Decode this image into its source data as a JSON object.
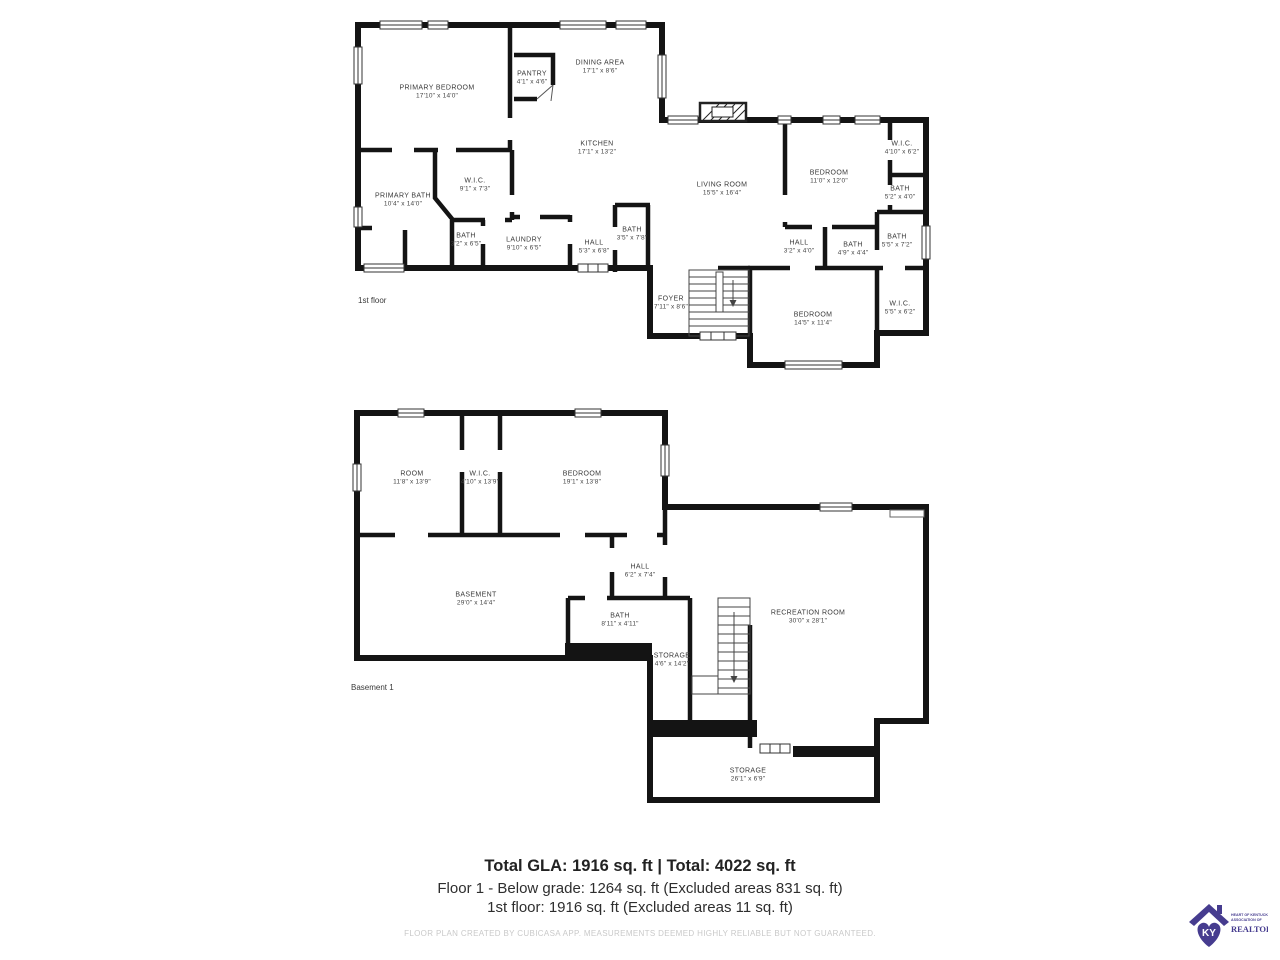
{
  "floors": [
    {
      "id": "floor-1",
      "label": "1st floor",
      "label_pos": {
        "x": 358,
        "y": 296
      },
      "rooms": [
        {
          "name": "PRIMARY BEDROOM",
          "dims": "17'10\" x 14'0\"",
          "x": 437,
          "y": 92
        },
        {
          "name": "PANTRY",
          "dims": "4'1\" x 4'6\"",
          "x": 532,
          "y": 78
        },
        {
          "name": "DINING AREA",
          "dims": "17'1\" x 8'6\"",
          "x": 600,
          "y": 67
        },
        {
          "name": "KITCHEN",
          "dims": "17'1\" x 13'2\"",
          "x": 597,
          "y": 148
        },
        {
          "name": "W.I.C.",
          "dims": "9'1\" x 7'3\"",
          "x": 475,
          "y": 185
        },
        {
          "name": "PRIMARY BATH",
          "dims": "10'4\" x 14'0\"",
          "x": 403,
          "y": 200
        },
        {
          "name": "BATH",
          "dims": "3'2\" x 6'5\"",
          "x": 466,
          "y": 240
        },
        {
          "name": "LAUNDRY",
          "dims": "9'10\" x 6'5\"",
          "x": 524,
          "y": 244
        },
        {
          "name": "HALL",
          "dims": "5'3\" x 6'8\"",
          "x": 594,
          "y": 247
        },
        {
          "name": "BATH",
          "dims": "3'5\" x 7'8\"",
          "x": 632,
          "y": 234
        },
        {
          "name": "LIVING ROOM",
          "dims": "15'5\" x 16'4\"",
          "x": 722,
          "y": 189
        },
        {
          "name": "FOYER",
          "dims": "7'11\" x 8'6\"",
          "x": 671,
          "y": 303
        },
        {
          "name": "BEDROOM",
          "dims": "11'0\" x 12'0\"",
          "x": 829,
          "y": 177
        },
        {
          "name": "W.I.C.",
          "dims": "4'10\" x 6'2\"",
          "x": 902,
          "y": 148
        },
        {
          "name": "BATH",
          "dims": "5'2\" x 4'0\"",
          "x": 900,
          "y": 193
        },
        {
          "name": "HALL",
          "dims": "3'2\" x 4'0\"",
          "x": 799,
          "y": 247
        },
        {
          "name": "BATH",
          "dims": "4'9\" x 4'4\"",
          "x": 853,
          "y": 249
        },
        {
          "name": "BATH",
          "dims": "5'5\" x 7'2\"",
          "x": 897,
          "y": 241
        },
        {
          "name": "BEDROOM",
          "dims": "14'5\" x 11'4\"",
          "x": 813,
          "y": 319
        },
        {
          "name": "W.I.C.",
          "dims": "5'5\" x 6'2\"",
          "x": 900,
          "y": 308
        }
      ]
    },
    {
      "id": "basement-1",
      "label": "Basement 1",
      "label_pos": {
        "x": 351,
        "y": 683
      },
      "rooms": [
        {
          "name": "ROOM",
          "dims": "11'8\" x 13'9\"",
          "x": 412,
          "y": 478
        },
        {
          "name": "W.I.C.",
          "dims": "4'10\" x 13'9\"",
          "x": 480,
          "y": 478
        },
        {
          "name": "BEDROOM",
          "dims": "19'1\" x 13'8\"",
          "x": 582,
          "y": 478
        },
        {
          "name": "BASEMENT",
          "dims": "29'0\" x 14'4\"",
          "x": 476,
          "y": 599
        },
        {
          "name": "HALL",
          "dims": "6'2\" x 7'4\"",
          "x": 640,
          "y": 571
        },
        {
          "name": "BATH",
          "dims": "8'11\" x 4'11\"",
          "x": 620,
          "y": 620
        },
        {
          "name": "STORAGE",
          "dims": "4'6\" x 14'2\"",
          "x": 672,
          "y": 660
        },
        {
          "name": "RECREATION ROOM",
          "dims": "30'0\" x 28'1\"",
          "x": 808,
          "y": 617
        },
        {
          "name": "STORAGE",
          "dims": "26'1\" x 6'9\"",
          "x": 748,
          "y": 775
        }
      ]
    }
  ],
  "summary": {
    "line1": "Total GLA: 1916 sq. ft | Total: 4022 sq. ft",
    "line2": "Floor 1 - Below grade: 1264 sq. ft (Excluded areas 831 sq. ft)",
    "line3": "1st floor: 1916 sq. ft (Excluded areas 11 sq. ft)",
    "disclaimer": "FLOOR PLAN CREATED BY CUBICASA APP. MEASUREMENTS DEEMED HIGHLY RELIABLE BUT NOT GUARANTEED."
  },
  "logo": {
    "monogram": "KY",
    "org_line1": "HEART OF KENTUCKY",
    "org_line2": "ASSOCIATION OF",
    "org_line3": "REALTORS®",
    "color": "#463c8f"
  }
}
